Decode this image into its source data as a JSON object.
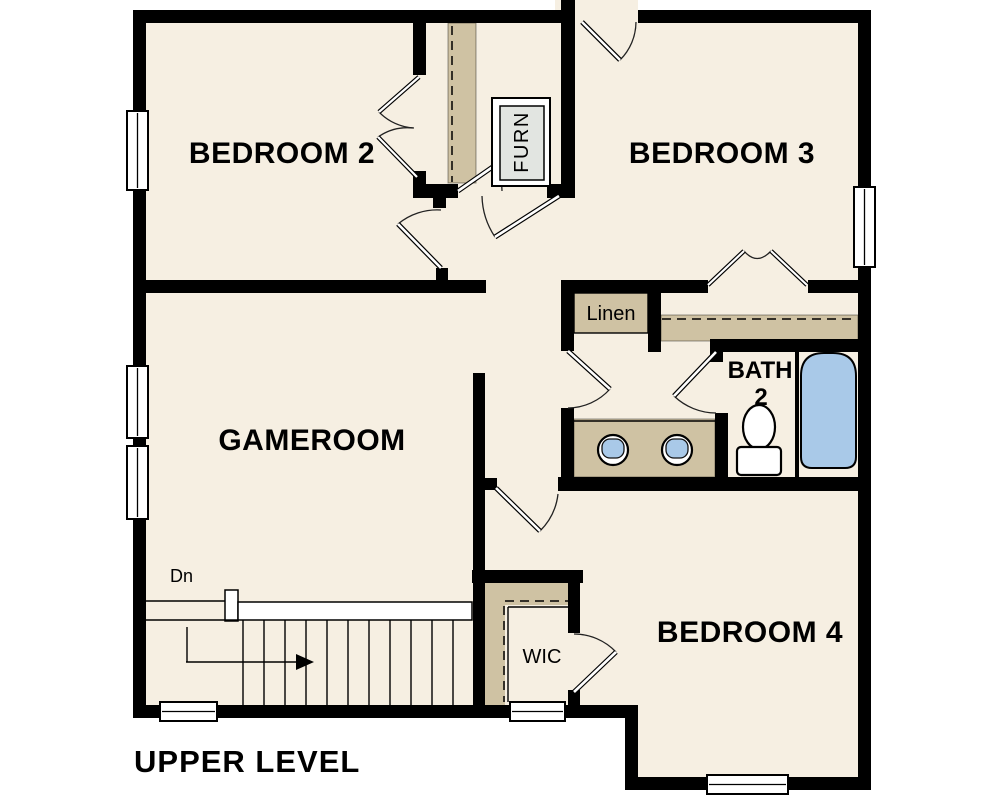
{
  "title": "UPPER LEVEL",
  "rooms": {
    "bedroom2": "BEDROOM 2",
    "bedroom3": "BEDROOM 3",
    "bedroom4": "BEDROOM 4",
    "gameroom": "GAMEROOM",
    "bath_name": "BATH",
    "bath_number": "2"
  },
  "closets": {
    "linen": "Linen",
    "wic": "WIC",
    "furnace": "FURN"
  },
  "stairs": {
    "direction_label": "Dn"
  },
  "colors": {
    "background": "#ffffff",
    "floor": "#f6efe2",
    "wall": "#000000",
    "closet_tan": "#cfc2a3",
    "fixture_blue": "#a9c9e8",
    "furn_gray": "#e2e5e1"
  }
}
